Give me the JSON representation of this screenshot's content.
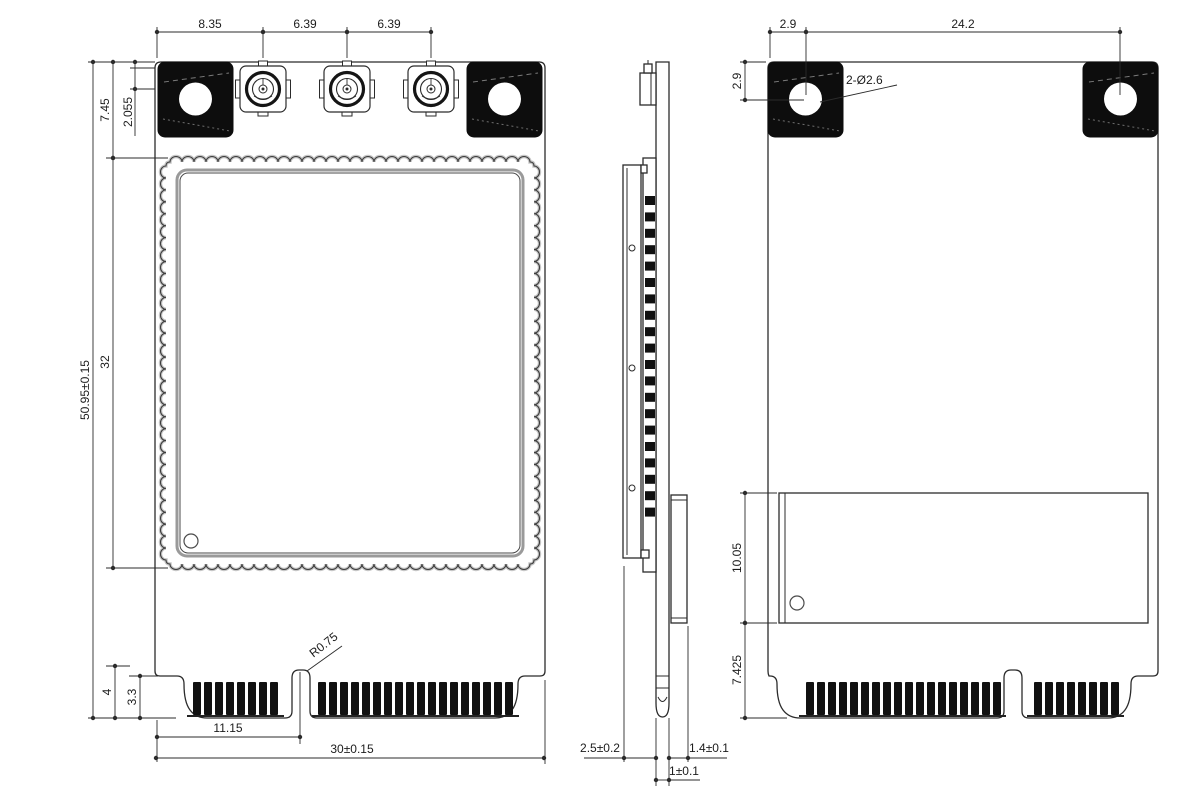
{
  "drawing": {
    "front_view": {
      "dim_edge_to_ant1": "8.35",
      "dim_ant1_to_ant2": "6.39",
      "dim_ant2_to_ant3": "6.39",
      "dim_top_zone_height": "7.45",
      "dim_ant_center_offset": "2.055",
      "dim_board_height": "50.95±0.15",
      "dim_shield_height": "32",
      "dim_notch_depth": "4",
      "dim_finger_height": "3.3",
      "dim_key_offset": "11.15",
      "dim_board_width": "30±0.15",
      "label_notch_radius": "R0.75"
    },
    "side_view": {
      "dim_module_stack": "2.5±0.2",
      "dim_pcb_thickness": "1±0.1",
      "dim_component_side": "1.4±0.1"
    },
    "back_view": {
      "dim_hole_to_edge": "2.9",
      "dim_hole_pitch": "24.2",
      "dim_hole_to_top": "2.9",
      "label_mounting_holes": "2-Ø2.6",
      "dim_label_height": "10.05",
      "dim_label_to_edge": "7.425"
    },
    "colors": {
      "line": "#2b2b2b",
      "fill_black": "#0d0d0d",
      "plate_gray": "#9a9a9a",
      "scallop_gray": "#c6c6c6"
    }
  }
}
